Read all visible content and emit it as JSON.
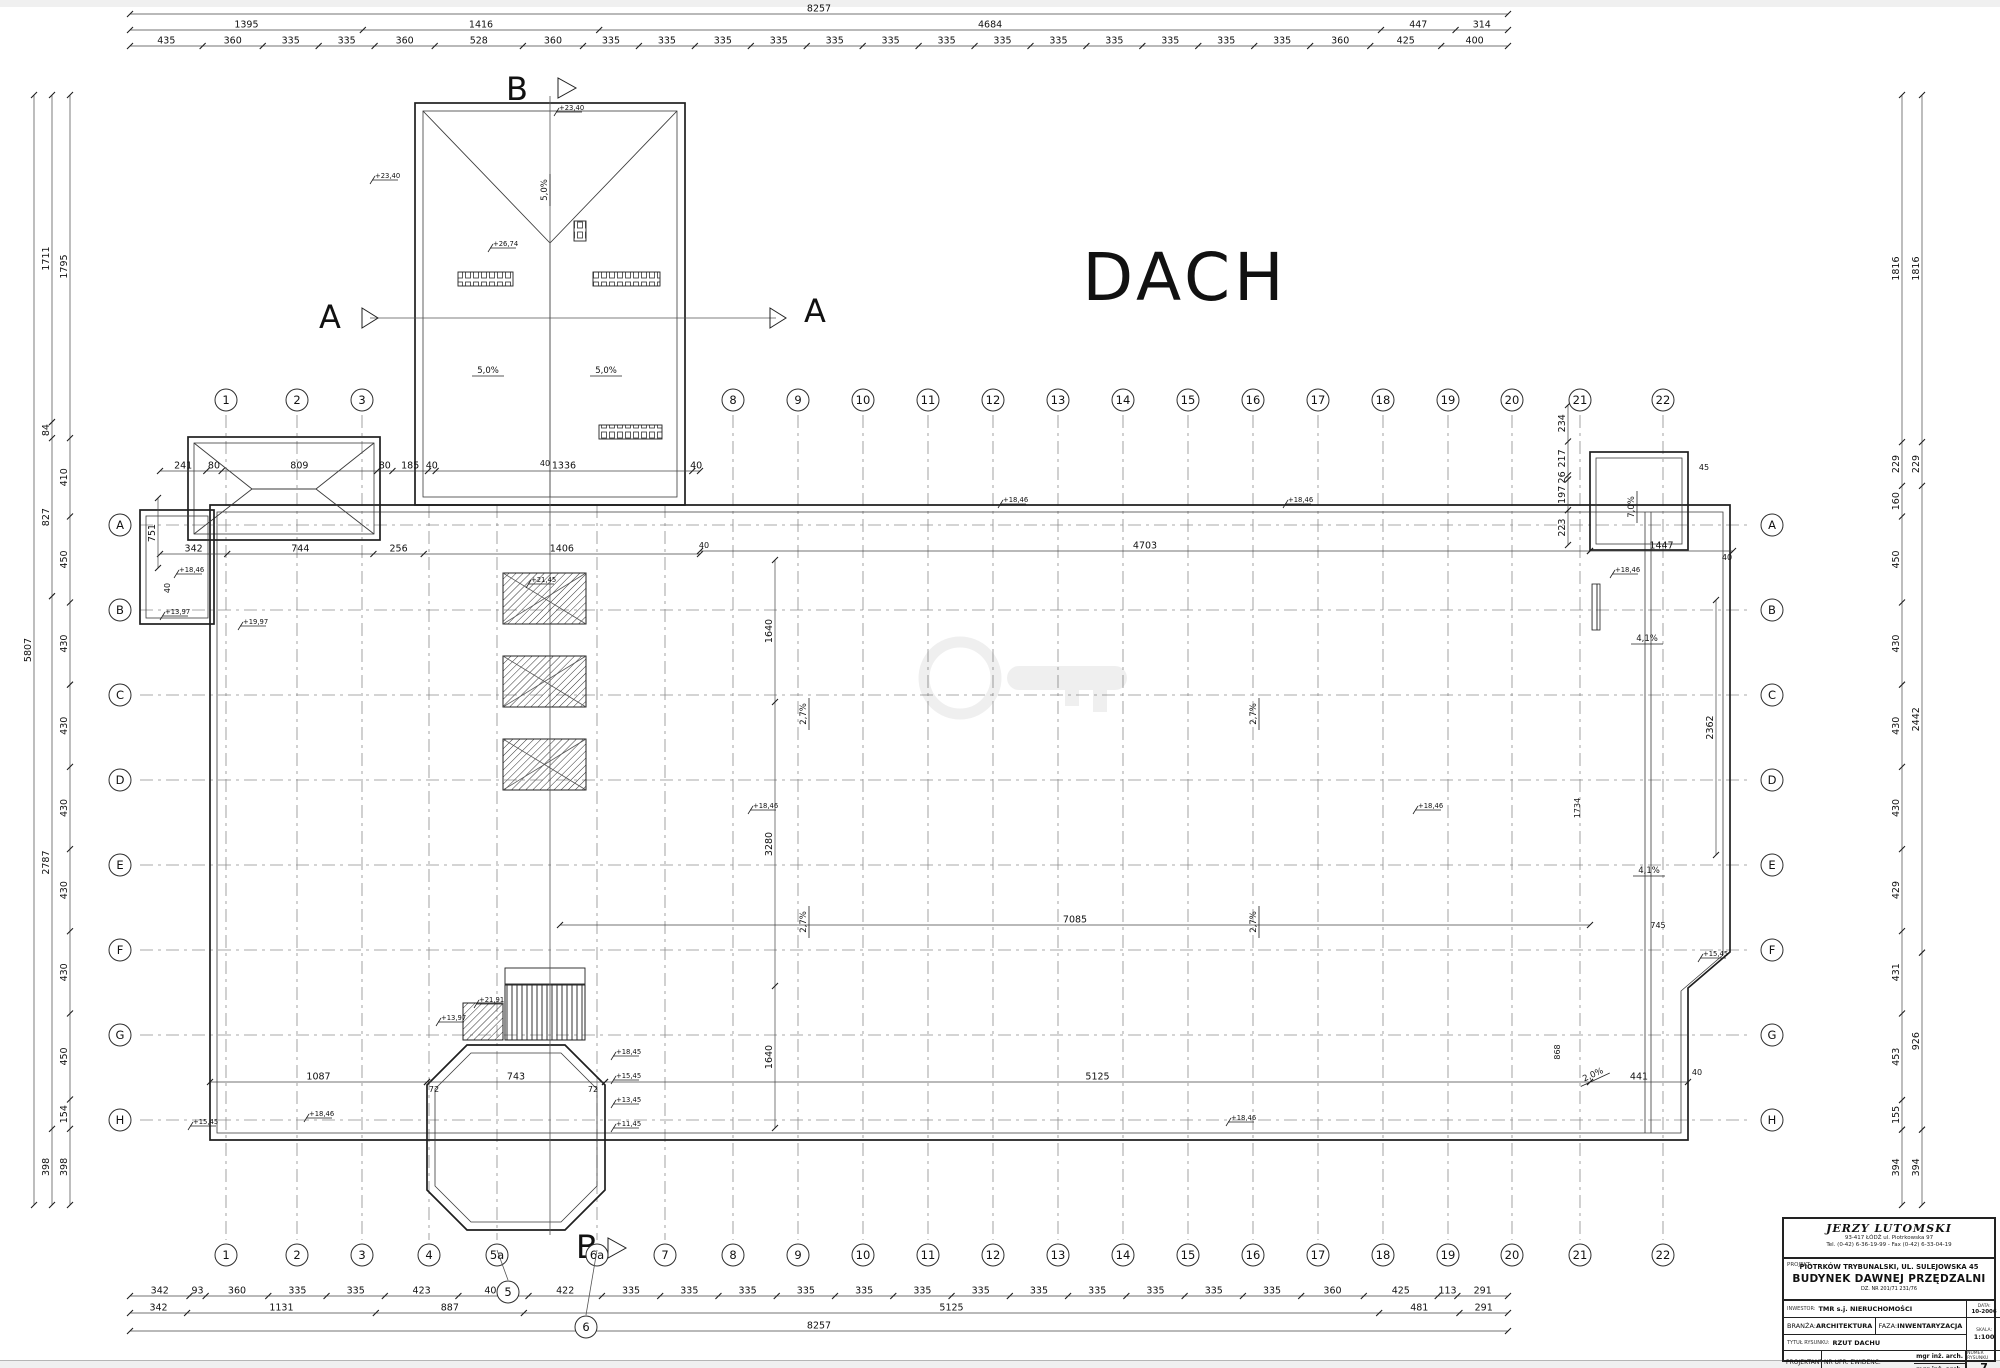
{
  "title": "DACH",
  "sections": {
    "a": "A",
    "b": "B"
  },
  "grid": {
    "cols_top": [
      "1",
      "2",
      "3",
      "8",
      "9",
      "10",
      "11",
      "12",
      "13",
      "14",
      "15",
      "16",
      "17",
      "18",
      "19",
      "20",
      "21",
      "22"
    ],
    "cols_bottom": [
      "1",
      "2",
      "3",
      "4",
      "5a",
      "6a",
      "7",
      "8",
      "9",
      "10",
      "11",
      "12",
      "13",
      "14",
      "15",
      "16",
      "17",
      "18",
      "19",
      "20",
      "21",
      "22"
    ],
    "extra": [
      "5",
      "6"
    ],
    "rows": [
      "A",
      "B",
      "C",
      "D",
      "E",
      "F",
      "G",
      "H"
    ]
  },
  "dims": {
    "top": {
      "total": [
        "8257"
      ],
      "mid": [
        "1395",
        "1416",
        "4684",
        "447",
        "314"
      ],
      "fine": [
        "435",
        "360",
        "335",
        "335",
        "360",
        "528",
        "360",
        "335",
        "335",
        "335",
        "335",
        "335",
        "335",
        "335",
        "335",
        "335",
        "335",
        "335",
        "335",
        "335",
        "360",
        "425",
        "400"
      ]
    },
    "bottom": {
      "fine": [
        "342",
        "93",
        "360",
        "335",
        "335",
        "423",
        "403",
        "422",
        "335",
        "335",
        "335",
        "335",
        "335",
        "335",
        "335",
        "335",
        "335",
        "335",
        "335",
        "335",
        "360",
        "425",
        "113",
        "291"
      ],
      "mid": [
        "342",
        "1131",
        "887",
        "5125",
        "481",
        "291"
      ],
      "total": [
        "8257"
      ]
    },
    "left": {
      "outer": [
        "5807"
      ],
      "mid": [
        "1711",
        "84",
        "827",
        "2787",
        "398"
      ],
      "inner": [
        "1795",
        "410",
        "450",
        "430",
        "430",
        "430",
        "430",
        "430",
        "450",
        "154",
        "398"
      ]
    },
    "right": {
      "inner": [
        "1816",
        "229",
        "160",
        "450",
        "430",
        "430",
        "430",
        "429",
        "431",
        "453",
        "155",
        "394"
      ],
      "mid": [
        "1816",
        "229",
        "2442",
        "926",
        "394"
      ]
    },
    "inner_rows": {
      "tower_top": [
        "241",
        "80",
        "809",
        "80",
        "185",
        "40",
        "1336",
        "40"
      ],
      "tower_mid": [
        "342",
        "744",
        "256",
        "1406"
      ],
      "r4703": [
        "4703"
      ],
      "r1447": [
        "1447"
      ],
      "r7085": [
        "7085"
      ],
      "r5125": [
        "5125"
      ],
      "r1087": [
        "1087"
      ],
      "r743": [
        "743"
      ],
      "r441": [
        "441"
      ],
      "v751": [
        "751"
      ],
      "v_trio": [
        "1640",
        "3280",
        "1640"
      ],
      "v2362": [
        "2362"
      ],
      "v_rtower": [
        "234",
        "217",
        "26",
        "197",
        "223"
      ]
    }
  },
  "plan": {
    "texts": [
      "72",
      "72",
      "1734",
      "745",
      "868",
      "40",
      "40",
      "40",
      "40",
      "40",
      "45"
    ],
    "levels": [
      "+23,40",
      "+23,40",
      "+26,74",
      "+18,46",
      "+18,46",
      "+13,97",
      "+19,97",
      "+18,46",
      "+21,45",
      "+18,46",
      "+18,46",
      "+18,46",
      "+18,46",
      "+15,45",
      "+21,91",
      "+13,97",
      "+18,45",
      "+15,45",
      "+13,45",
      "+11,45",
      "+18,46",
      "+15,45"
    ],
    "slopes": [
      "5,0%",
      "5,0%",
      "5,0%",
      "2,7%",
      "2,7%",
      "2,7%",
      "2,7%",
      "4,1%",
      "4,1%",
      "7,0%",
      "2,0%"
    ]
  },
  "titleblock": {
    "company_name": "JERZY LUTOMSKI",
    "company_addr": "93-417 ŁÓDŹ  ul. Piotrkowska 97",
    "company_tel": "Tel. (0-42) 6-36-19-99  -  Fax (0-42) 6-33-04-19",
    "projekt_label": "PROJEKT:",
    "projekt_line1": "PIOTRKÓW TRYBUNALSKI, UL. SULEJOWSKA 45",
    "projekt_line2": "BUDYNEK DAWNEJ PRZĘDZALNI",
    "projekt_line3": "DZ. NR 201/71 231/76",
    "inwestor_label": "INWESTOR:",
    "inwestor_value": "TMR s.j. NIERUCHOMOŚCI",
    "branza_label": "BRANŻA:",
    "branza_value": "ARCHITEKTURA",
    "faza_label": "FAZA:",
    "faza_value": "INWENTARYZACJA",
    "tytul_label": "TYTUŁ RYSUNKU:",
    "tytul_value": "RZUT DACHU",
    "projektant_label": "PROJEKTANT:",
    "projektant_name1": "mgr inż. arch. Bożena Nowacka",
    "projektant_name2": "mgr inż. arch. Monika Sieradzka",
    "nr_upr_label": "NR UPR. EWIDENC.",
    "data_label": "DATA:",
    "data_value": "10-2006",
    "skala_label": "SKALA:",
    "skala_value": "1:100",
    "numer_label": "NUMER RYSUNKU",
    "numer_value": "7"
  }
}
